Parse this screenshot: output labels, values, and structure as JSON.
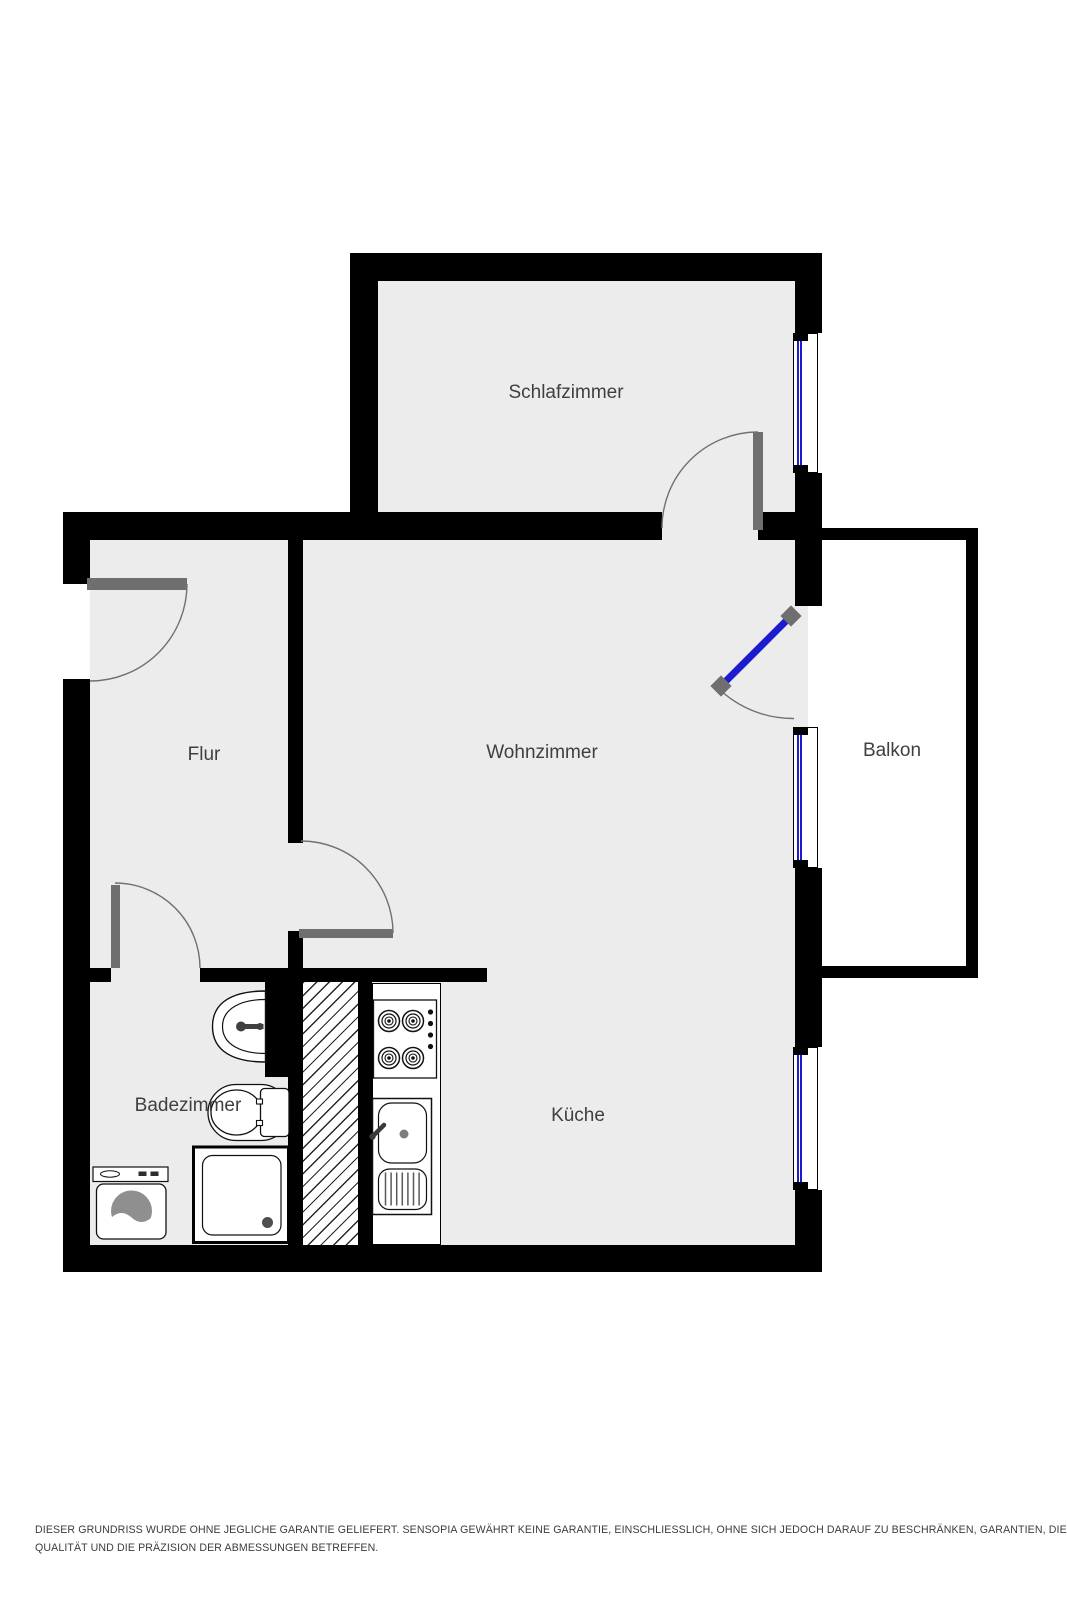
{
  "page": {
    "background": "#ffffff",
    "width": 1067,
    "height": 1600
  },
  "colors": {
    "wall": "#000000",
    "floor": "#ececec",
    "door_leaf": "#6f6f6f",
    "swing_arc": "#707070",
    "window_glass": "#1c1ccd",
    "window_frame": "#000000",
    "label_text": "#3f3f3f",
    "disclaimer_text": "#3c3c3c",
    "appliance_outline": "#111111",
    "drum_fill": "#8f8f8f"
  },
  "rooms": [
    {
      "id": "schlafzimmer",
      "label": "Schlafzimmer"
    },
    {
      "id": "flur",
      "label": "Flur"
    },
    {
      "id": "wohnzimmer",
      "label": "Wohnzimmer"
    },
    {
      "id": "balkon",
      "label": "Balkon"
    },
    {
      "id": "badezimmer",
      "label": "Badezimmer"
    },
    {
      "id": "kueche",
      "label": "Küche"
    }
  ],
  "features": {
    "windows": [
      "schlafzimmer-window",
      "wohnzimmer-window",
      "kueche-window"
    ],
    "doors": [
      "entrance-door",
      "badezimmer-door",
      "wohnzimmer-flur-door",
      "schlafzimmer-door",
      "balkon-door"
    ],
    "fixtures": [
      "washbasin",
      "toilet",
      "shower",
      "washing-machine",
      "duct-shaft",
      "stove",
      "kitchen-sink"
    ]
  },
  "disclaimer": {
    "line1": "DIESER GRUNDRISS WURDE OHNE JEGLICHE GARANTIE GELIEFERT. SENSOPIA GEWÄHRT KEINE GARANTIE, EINSCHLIESSLICH, OHNE SICH JEDOCH DARAUF ZU BESCHRÄNKEN, GARANTIEN, DIE DIE",
    "line2": "QUALITÄT UND DIE PRÄZISION DER ABMESSUNGEN BETREFFEN."
  }
}
